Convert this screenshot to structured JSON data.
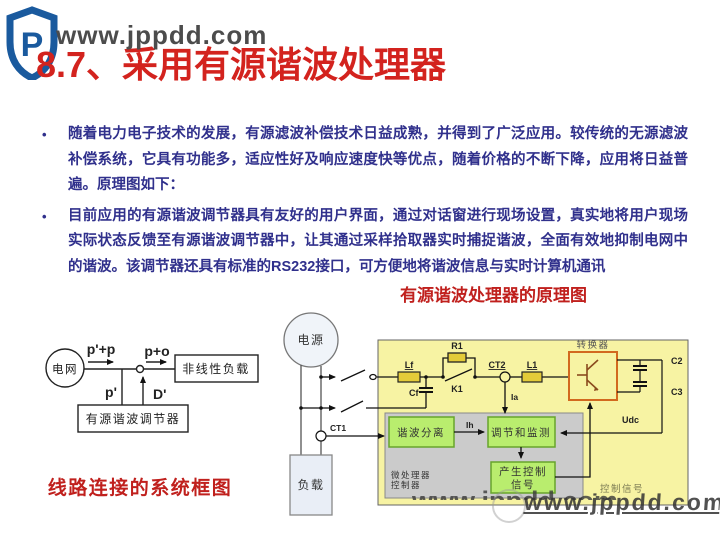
{
  "title": {
    "text": "8.7、采用有源谐波处理器",
    "color": "#d3231e"
  },
  "watermark": {
    "top": "www.jppdd.com",
    "bottom": "www.jppdd.com"
  },
  "bullets": [
    {
      "marker": "•",
      "text": "随着电力电子技术的发展，有源滤波补偿技术日益成熟，并得到了广泛应用。较传统的无源滤波补偿系统，它具有功能多，适应性好及响应速度快等优点，随着价格的不断下降，应用将日益普遍。原理图如下："
    },
    {
      "marker": "•",
      "text": "目前应用的有源谐波调节器具有友好的用户界面，通过对话窗进行现场设置，真实地将用户现场实际状态反馈至有源谐波调节器中，让其通过采样拾取器实时捕捉谐波，全面有效地抑制电网中的谐波。该调节器还具有标准的RS232接口，可方便地将谐波信息与实时计算机通讯"
    }
  ],
  "captions": {
    "right": "有源谐波处理器的原理图",
    "left": "线路连接的系统框图",
    "color": "#c0201d"
  },
  "left_diagram": {
    "labels": {
      "source": "电网",
      "load": "非线性负载",
      "regulator": "有源谐波调节器",
      "flow_top": "p'+p",
      "flow_right": "p+o",
      "flow_p": "p'",
      "flow_d": "D'"
    }
  },
  "right_diagram": {
    "labels": {
      "source": "电源",
      "load": "负载",
      "ct1": "CT1",
      "lf": "Lf",
      "cf": "Cf",
      "r1": "R1",
      "k1": "K1",
      "ct2": "CT2",
      "l1": "L1",
      "converter": "转换器",
      "c2": "C2",
      "c3": "C3",
      "ia": "Ia",
      "ih": "Ih",
      "udc": "Udc",
      "box_separation": "谐波分离",
      "box_regulation": "调节和监测",
      "box_generate_line1": "产生控制",
      "box_generate_line2": "信号",
      "mcu_line1": "微处理器",
      "mcu_line2": "控制器",
      "ctrl_signal": "控制信号"
    },
    "colors": {
      "panel": "#f7f3a3",
      "component": "#e3cb39",
      "green_fill": "#b9ed6e",
      "green_border": "#67a42c",
      "gray_box": "#cbcbcb",
      "converter_border": "#d2691e"
    }
  },
  "logo": {
    "letter": "P",
    "color": "#1a5a9e"
  }
}
